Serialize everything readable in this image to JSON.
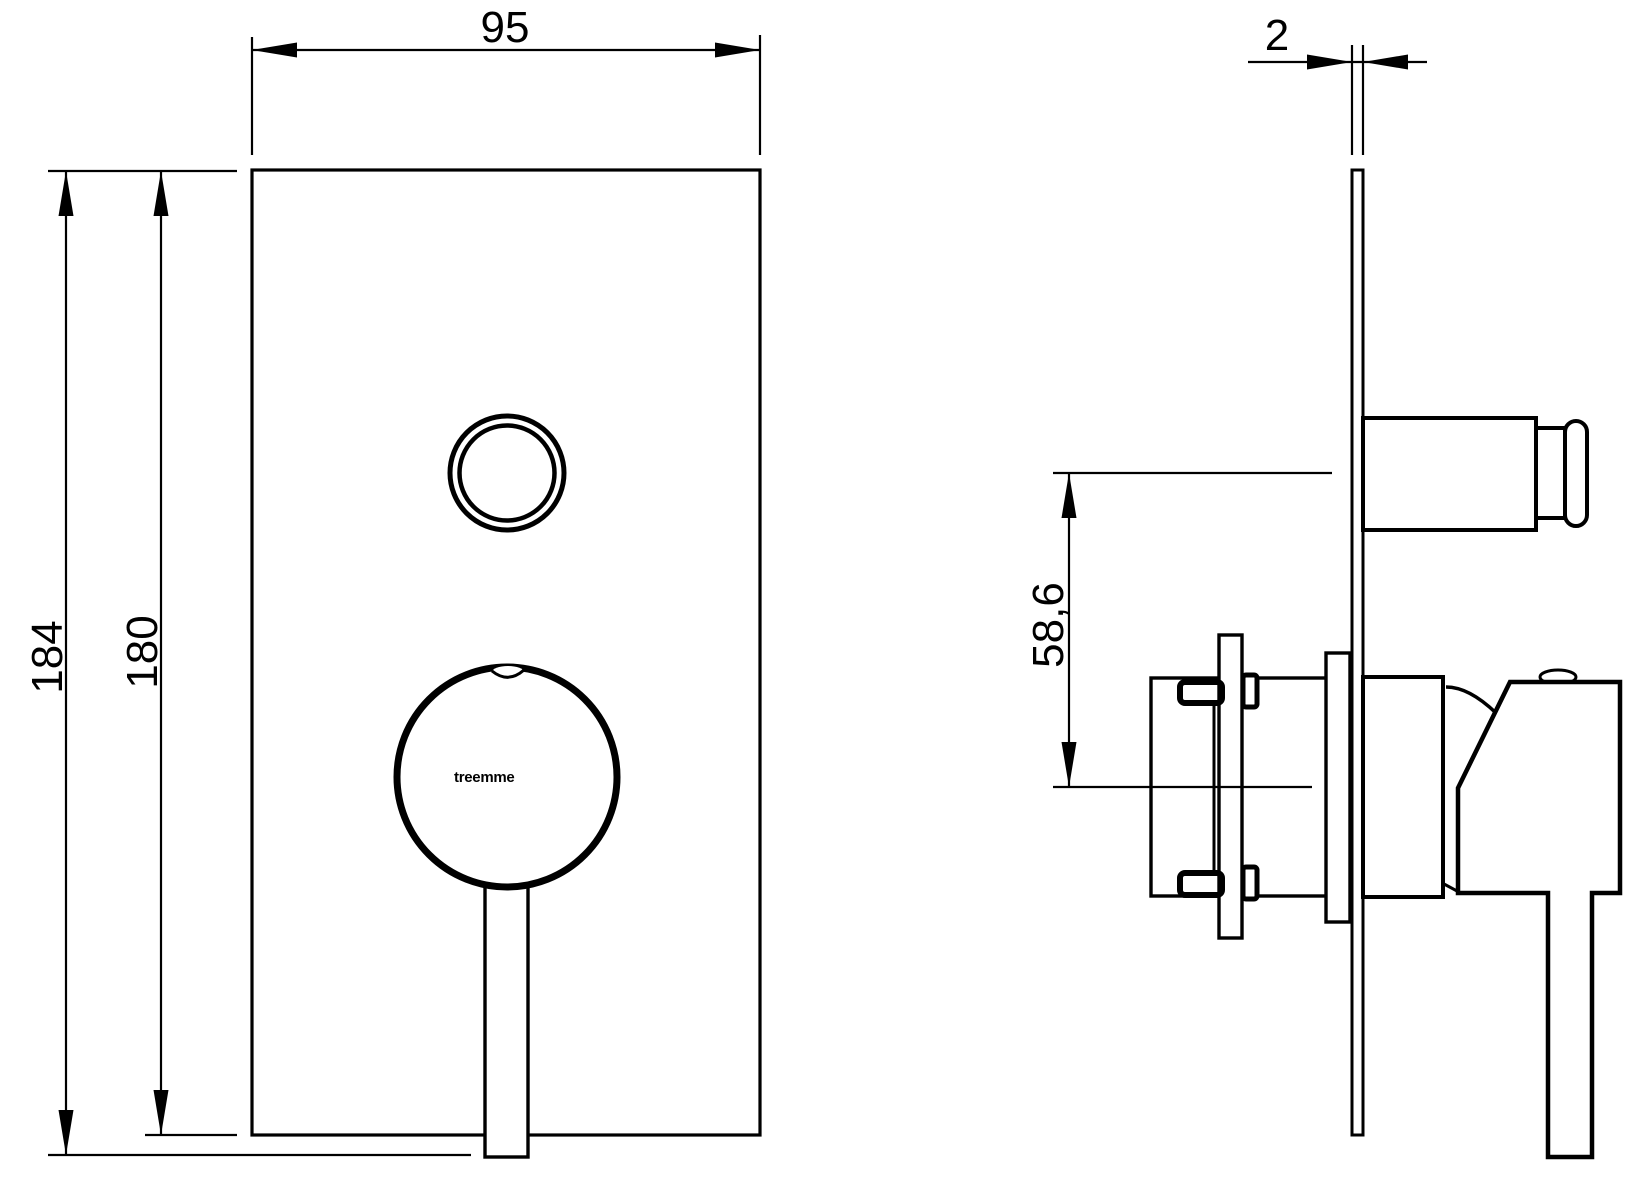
{
  "page": {
    "background_color": "#ffffff",
    "line_color": "#000000",
    "description": "Technical dimension drawing of a concealed shower mixer trim plate, front and side views"
  },
  "front_view": {
    "width_dim": "95",
    "overall_height_dim": "184",
    "plate_height_dim": "180",
    "logo": "treemme"
  },
  "side_view": {
    "plate_thickness_dim": "2",
    "button_axis_offset_dim": "58,6"
  }
}
